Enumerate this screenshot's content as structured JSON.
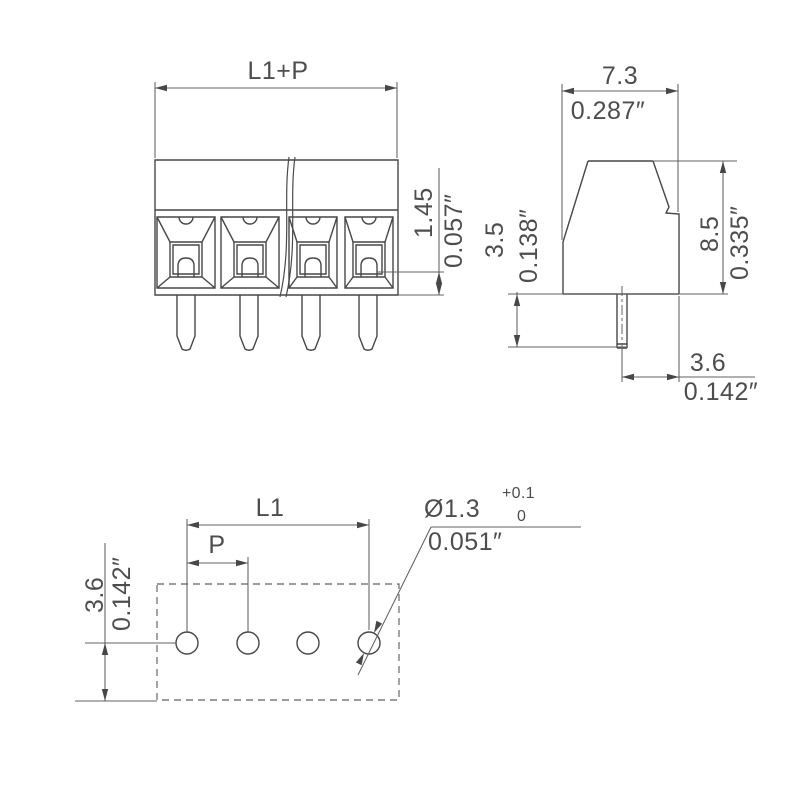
{
  "colors": {
    "background": "#ffffff",
    "line": "#4d4d4d"
  },
  "front_view": {
    "total_pitch_label": "L1+P",
    "clamp_bottom_mm": "1.45",
    "clamp_bottom_in": "0.057″"
  },
  "side_view": {
    "width_mm": "7.3",
    "width_in": "0.287″",
    "pin_length_mm": "3.5",
    "pin_length_in": "0.138″",
    "height_mm": "8.5",
    "height_in": "0.335″",
    "pin_offset_mm": "3.6",
    "pin_offset_in": "0.142″"
  },
  "board_view": {
    "length_label": "L1",
    "pitch_label": "P",
    "edge_distance_mm": "3.6",
    "edge_distance_in": "0.142″",
    "hole_diameter": "Ø1.3",
    "hole_tolerance_upper": "+0.1",
    "hole_tolerance_lower": "0",
    "hole_diameter_in": "0.051″"
  }
}
